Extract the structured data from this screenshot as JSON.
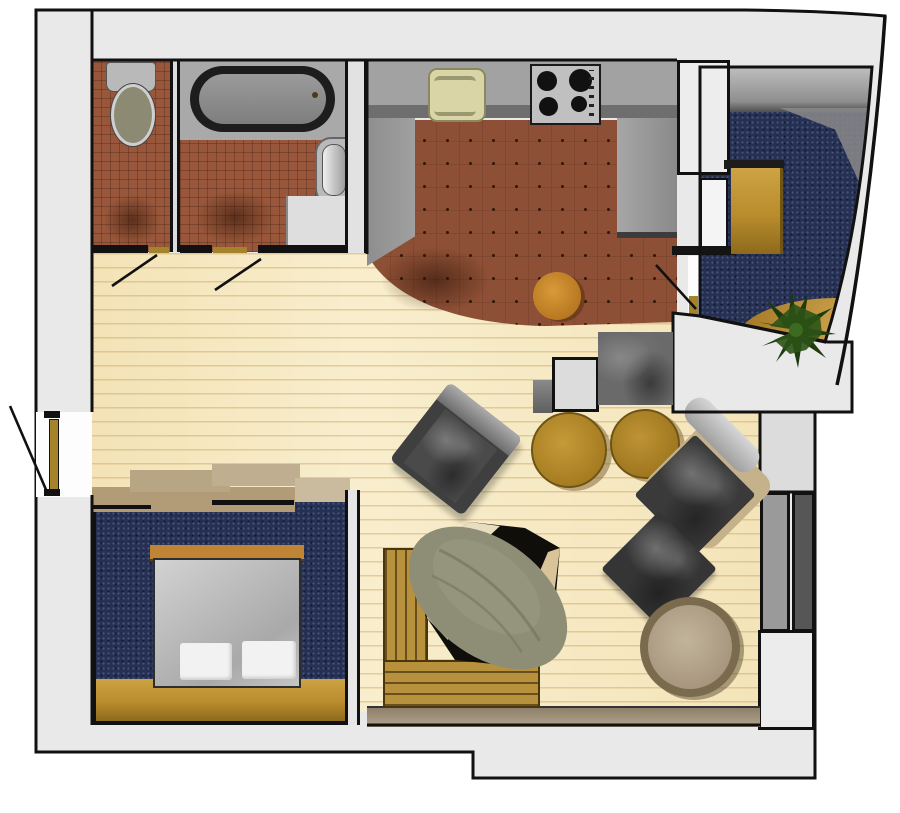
{
  "title": "apartment-floor-plan",
  "palette": {
    "wall_fill": "#e9e9e9",
    "outline": "#111111",
    "tile_bath": "#98573a",
    "tile_kitchen": "#8d4f35",
    "carpet_navy": "#263052",
    "wood_hall": "#f8eecd",
    "wood_frame": "#b8913c",
    "counter_gray": "#999999",
    "sink_beige": "#d9d5a6",
    "stove_steel": "#c0c0c0",
    "duvet_gray": "#bcbcbc",
    "pillow_white": "#f2f2f2",
    "table_amber": "#b78c2f",
    "dining_tan": "#b4a287",
    "chair_dark": "#3d3d3d",
    "mattress_olive": "#8e8e76",
    "plant_green": "#2c5317",
    "threshold_gold": "#a5832a",
    "window_glass": "#565656"
  },
  "rooms": [
    {
      "id": "wc",
      "label": "WC"
    },
    {
      "id": "bathroom",
      "label": "Bathroom"
    },
    {
      "id": "kitchen",
      "label": "Kitchen"
    },
    {
      "id": "balcony-room",
      "label": "Loggia / study"
    },
    {
      "id": "hall-living",
      "label": "Hall and living room"
    },
    {
      "id": "bedroom",
      "label": "Bedroom"
    }
  ],
  "fixtures": [
    {
      "id": "toilet",
      "label": "Toilet"
    },
    {
      "id": "bathtub",
      "label": "Bathtub"
    },
    {
      "id": "washbasin",
      "label": "Washbasin"
    },
    {
      "id": "kitchen-sink",
      "label": "Kitchen sink"
    },
    {
      "id": "stove",
      "label": "Stove with 4 burners"
    },
    {
      "id": "kitchen-stool",
      "label": "Round stool"
    },
    {
      "id": "desk",
      "label": "Desk"
    },
    {
      "id": "plant",
      "label": "Potted plant"
    },
    {
      "id": "bed",
      "label": "Double bed with two pillows"
    },
    {
      "id": "futon-frame",
      "label": "Wooden daybed frame"
    },
    {
      "id": "cowhide-rug",
      "label": "Cowhide rug"
    },
    {
      "id": "mattress",
      "label": "Olive mattress"
    },
    {
      "id": "armchair",
      "label": "Armchair"
    },
    {
      "id": "chaise",
      "label": "Chaise lounge"
    },
    {
      "id": "ottoman",
      "label": "Ottoman"
    },
    {
      "id": "side-table-1",
      "label": "Round side table"
    },
    {
      "id": "side-table-2",
      "label": "Round side table"
    },
    {
      "id": "dining-table",
      "label": "Round dining table"
    },
    {
      "id": "tv-cabinet",
      "label": "Dark cabinet"
    },
    {
      "id": "white-cabinet",
      "label": "White cabinet"
    }
  ],
  "doors": [
    {
      "id": "entry-door",
      "label": "Apartment entrance door"
    },
    {
      "id": "wc-door",
      "label": "WC door"
    },
    {
      "id": "bath-door",
      "label": "Bathroom door"
    },
    {
      "id": "balcony-door",
      "label": "Kitchen to loggia door"
    }
  ]
}
